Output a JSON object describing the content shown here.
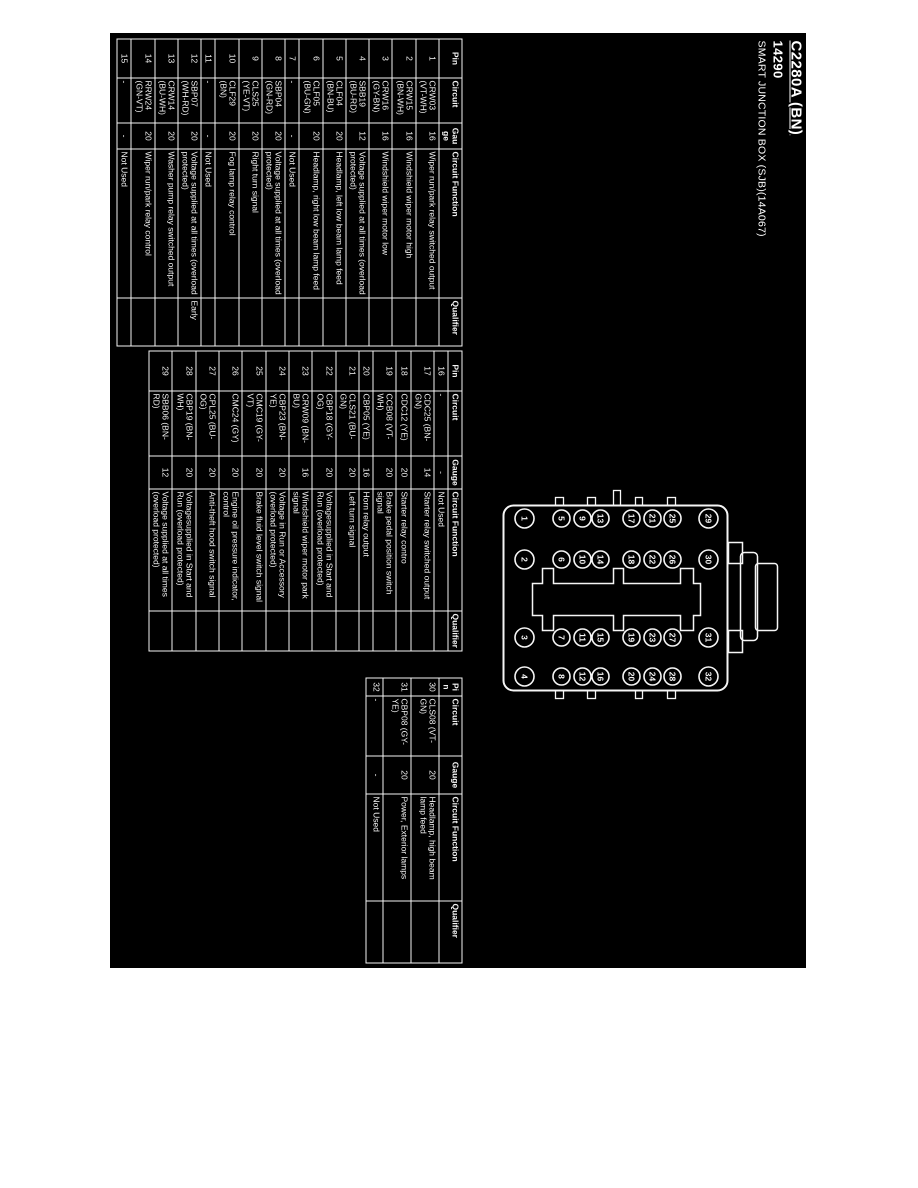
{
  "title": {
    "connector_id": "C2280A (BN)",
    "part_number": "14290",
    "component": "SMART JUNCTION BOX (SJB)(14A067)"
  },
  "columns": [
    "Pin",
    "Circuit",
    "Gauge",
    "Circuit Function",
    "Qualifier"
  ],
  "tables": [
    {
      "id": "pins-1-15",
      "rows": [
        [
          "1",
          "CRW03 (VT-WH)",
          "16",
          "Wiper run/park relay switched output",
          ""
        ],
        [
          "2",
          "CRW15 (BN-WH)",
          "16",
          "Windshield wiper motor high",
          ""
        ],
        [
          "3",
          "CRW16 (GY-BN)",
          "16",
          "Windshield wiper motor low",
          ""
        ],
        [
          "4",
          "SBB19 (BU-RD)",
          "12",
          "Voltage supplied at all times (overload protected)",
          ""
        ],
        [
          "5",
          "CLF04 (BN-BU)",
          "20",
          "Headlamp, left low beam lamp feed",
          ""
        ],
        [
          "6",
          "CLF05 (BU-GN)",
          "20",
          "Headlamp, right low beam lamp feed",
          ""
        ],
        [
          "7",
          "-",
          "-",
          "Not Used",
          ""
        ],
        [
          "8",
          "SBP04 (GN-RD)",
          "20",
          "Voltage supplied at all times (overload protected)",
          ""
        ],
        [
          "9",
          "CLS25 (YE-VT)",
          "20",
          "Right turn signal",
          ""
        ],
        [
          "10",
          "CLF29 (BN)",
          "20",
          "Fog lamp relay control",
          ""
        ],
        [
          "11",
          "-",
          "-",
          "Not Used",
          ""
        ],
        [
          "12",
          "SBP07 (WH-RD)",
          "20",
          "Voltage supplied at all times (overload protected)",
          "Early"
        ],
        [
          "13",
          "CRW14 (BU-WH)",
          "20",
          "Washer pump relay switched output",
          ""
        ],
        [
          "14",
          "RRW24 (GN-VT)",
          "20",
          "Wiper run/park relay control",
          ""
        ],
        [
          "15",
          "-",
          "-",
          "Not Used",
          ""
        ]
      ]
    },
    {
      "id": "pins-16-29",
      "rows": [
        [
          "16",
          "-",
          "-",
          "Not Used",
          ""
        ],
        [
          "17",
          "CDC25 (BN-GN)",
          "14",
          "Starter relay switched output",
          ""
        ],
        [
          "18",
          "CDC12 (YE)",
          "20",
          "Starter relay contro",
          ""
        ],
        [
          "19",
          "CCB08 (VT-WH)",
          "20",
          "Brake pedal position switch signal",
          ""
        ],
        [
          "20",
          "CBP05 (YE)",
          "16",
          "Horn relay output",
          ""
        ],
        [
          "21",
          "CLS21 (BU-GN)",
          "20",
          "Left turn signal",
          ""
        ],
        [
          "22",
          "CBP18 (GY-OG)",
          "20",
          "Voltagesupplied in Start and Run (overload protected)",
          ""
        ],
        [
          "23",
          "CRW09 (BN-BU)",
          "16",
          "Windshield wiper motor park signal",
          ""
        ],
        [
          "24",
          "CBP23 (BN-YE)",
          "20",
          "Voltage in Run or Accessory (overload protected)",
          ""
        ],
        [
          "25",
          "CMC19 (GY-VT)",
          "20",
          "Brake fluid level switch signal",
          ""
        ],
        [
          "26",
          "CMC24 (GY)",
          "20",
          "Engine oil pressure indicator, control",
          ""
        ],
        [
          "27",
          "CPL25 (BU-OG)",
          "20",
          "Anti-theft hood switch signal",
          ""
        ],
        [
          "28",
          "CBP19 (BN-WH)",
          "20",
          "Voltagesupplied in Start and Run (overload protected)",
          ""
        ],
        [
          "29",
          "SBB06 (BN-RD)",
          "12",
          "Voltage supplied at all times (overload protected)",
          ""
        ]
      ]
    },
    {
      "id": "pins-30-32",
      "rows": [
        [
          "30",
          "CLS08 (VT-GN)",
          "20",
          "Headlamp, high beam lamp feed",
          ""
        ],
        [
          "31",
          "CBP08 (GY-YE)",
          "20",
          "Power, Exterior lamps",
          ""
        ],
        [
          "32",
          "-",
          "-",
          "Not Used",
          ""
        ]
      ]
    }
  ],
  "connector_diagram": {
    "pin_grid": [
      [
        "29",
        "30",
        "31",
        "32"
      ],
      [
        "25",
        "26",
        "27",
        "28"
      ],
      [
        "21",
        "22",
        "23",
        "24"
      ],
      [
        "17",
        "18",
        "19",
        "20"
      ],
      [
        "13",
        "14",
        "15",
        "16"
      ],
      [
        "9",
        "10",
        "11",
        "12"
      ],
      [
        "5",
        "6",
        "7",
        "8"
      ],
      [
        "1",
        "2",
        "3",
        "4"
      ]
    ]
  },
  "colors": {
    "page_background": "#ffffff",
    "scan_background": "#000000",
    "ink": "#f5f5f5"
  }
}
